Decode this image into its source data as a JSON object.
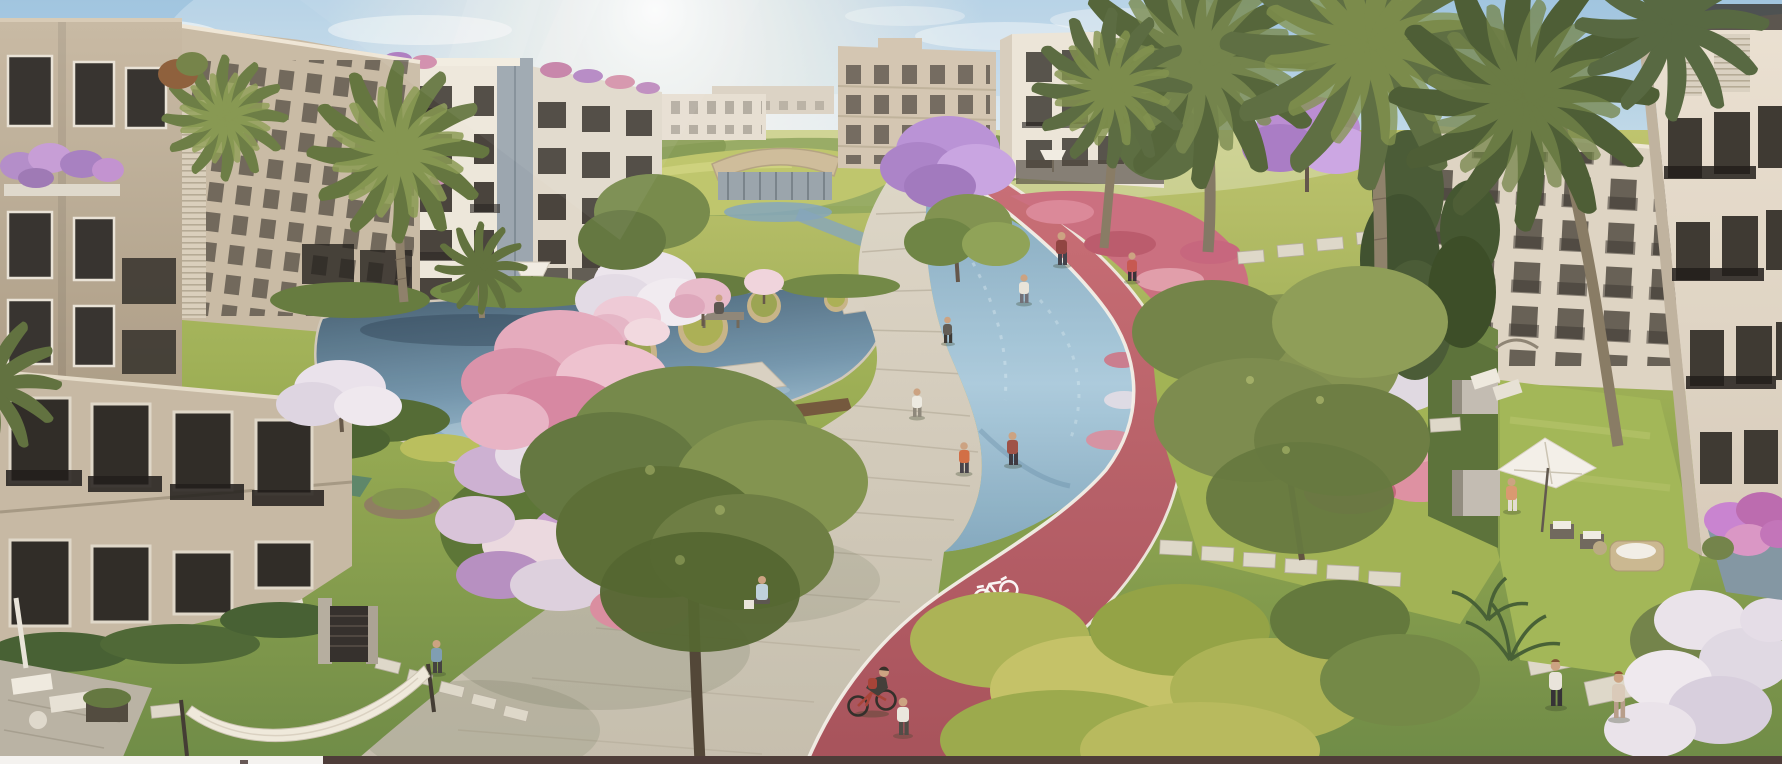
{
  "scene": {
    "title": "Aerial 3D rendering of a residential compound with lagoon walkway and red cycling track",
    "type": "architectural-render",
    "objects": [
      "apartment buildings",
      "palm trees",
      "jacaranda trees",
      "pink blossom trees",
      "lagoon pond with planted islands",
      "water canal",
      "concrete promenade",
      "red bicycle lane with painted bike symbol",
      "cyclist",
      "pedestrians",
      "flower beds",
      "hedges",
      "stepping stones",
      "garden umbrella",
      "hammock",
      "lounge chairs",
      "gazebo",
      "clubhouse pavilion",
      "private gardens",
      "garden gate"
    ],
    "approx_people_visible": 15
  },
  "palette": {
    "sky_top": "#9cc3e0",
    "sky_mid": "#c9dfec",
    "sky_low": "#eef3f4",
    "sun": "#ffffff",
    "water_hi": "#a9cadd",
    "water_lo": "#7fa6bd",
    "pond_hi": "#6f93ab",
    "pond_lo": "#3c576b",
    "walk_hi": "#dcd5c6",
    "walk_lo": "#c3bcab",
    "red_hi": "#c76a72",
    "red_lo": "#a34b55",
    "lane": "#f3f0e9",
    "lawn_hi": "#bcc269",
    "lawn_mid": "#94a94c",
    "lawn_lo": "#688740",
    "hedge": "#4d672f",
    "b1_hi": "#c6b8a2",
    "b1_lo": "#a4957e",
    "white_fac": "#ece7db",
    "beige_fac": "#d2c5b0",
    "b7_hi": "#eae1d2",
    "b7_lo": "#d5c9b8",
    "window": "#36322b",
    "blossom_pink": "#e0a0b6",
    "blossom_purple": "#b68bd4",
    "blossom_white": "#ebe5ee",
    "flower_red": "#c9647a",
    "palm": "#5b6d3a",
    "palm_light": "#8a9c50",
    "trunk": "#8a7c66",
    "bar_light": "#f4f2ef",
    "bar_dark": "#4e3d39"
  },
  "bottom_bar": {
    "light_segment_width_px": 323,
    "dark_segment_width_px": 1459,
    "height_px": 8
  }
}
